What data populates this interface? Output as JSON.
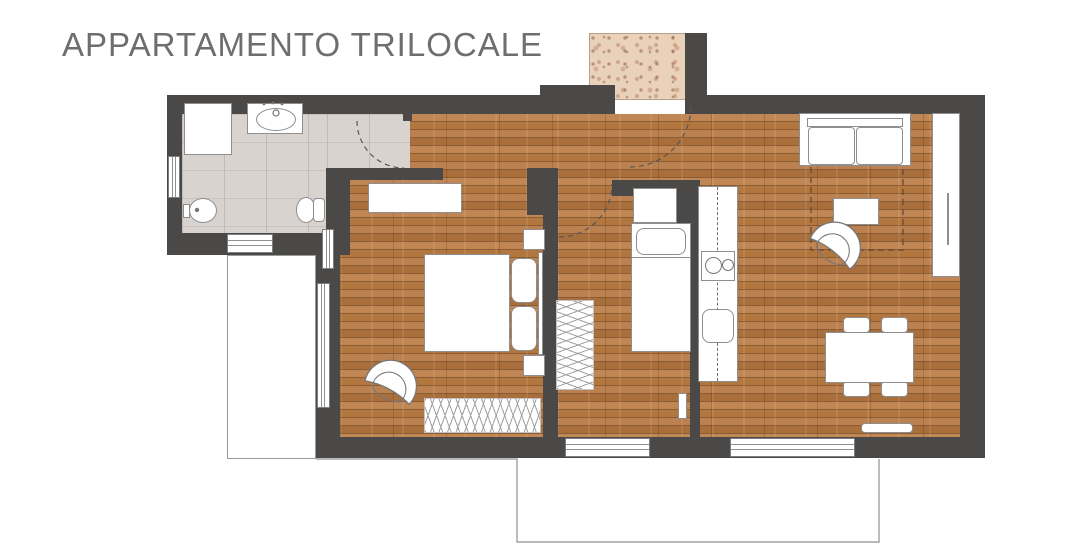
{
  "title": "APPARTAMENTO TRILOCALE",
  "colors": {
    "wall": "#4a4947",
    "wood": "#b57c48",
    "tile": "#d9d3d0",
    "landing": "#ead1ba",
    "outline": "#8e8e8e",
    "title": "#6e6e6e",
    "arc": "#565656",
    "terrace": "#8f8f8f",
    "rug-dash": "#6d4f34",
    "window-line": "#909090"
  },
  "plan": {
    "width": 1080,
    "height": 559,
    "rects": [
      {
        "name": "wood-floor",
        "cls": "wood",
        "x": 340,
        "y": 114,
        "w": 620,
        "h": 324
      },
      {
        "name": "bathroom-floor",
        "cls": "tile",
        "x": 182,
        "y": 114,
        "w": 145,
        "h": 119
      },
      {
        "name": "bathroom-vestibule-floor",
        "cls": "tile",
        "x": 327,
        "y": 114,
        "w": 83,
        "h": 54
      },
      {
        "name": "balcony-floor",
        "cls": "balcony",
        "x": 227,
        "y": 255,
        "w": 89,
        "h": 204
      },
      {
        "name": "entrance-landing",
        "cls": "landing",
        "x": 589,
        "y": 33,
        "w": 98,
        "h": 67
      },
      {
        "name": "wall-top-left",
        "cls": "wall",
        "x": 167,
        "y": 95,
        "w": 448,
        "h": 19
      },
      {
        "name": "wall-top-notch",
        "cls": "wall",
        "x": 540,
        "y": 85,
        "w": 75,
        "h": 12
      },
      {
        "name": "wall-entry-stub",
        "cls": "wall",
        "x": 685,
        "y": 33,
        "w": 22,
        "h": 81
      },
      {
        "name": "wall-top-right",
        "cls": "wall",
        "x": 685,
        "y": 95,
        "w": 300,
        "h": 19
      },
      {
        "name": "wall-right",
        "cls": "wall",
        "x": 960,
        "y": 95,
        "w": 25,
        "h": 363
      },
      {
        "name": "wall-bottom",
        "cls": "wall",
        "x": 316,
        "y": 437,
        "w": 669,
        "h": 21
      },
      {
        "name": "wall-left-bathroom",
        "cls": "wall",
        "x": 167,
        "y": 95,
        "w": 15,
        "h": 160
      },
      {
        "name": "wall-bathroom-bottom",
        "cls": "wall",
        "x": 167,
        "y": 233,
        "w": 160,
        "h": 22
      },
      {
        "name": "wall-bathroom-right",
        "cls": "wall",
        "x": 326,
        "y": 168,
        "w": 24,
        "h": 87
      },
      {
        "name": "wall-corner-bathroom-bedroom",
        "cls": "wall",
        "x": 316,
        "y": 233,
        "w": 24,
        "h": 50
      },
      {
        "name": "wall-bedroom1-left",
        "cls": "wall",
        "x": 316,
        "y": 255,
        "w": 24,
        "h": 182
      },
      {
        "name": "wall-bedroom1-top",
        "cls": "wall",
        "x": 340,
        "y": 168,
        "w": 103,
        "h": 12
      },
      {
        "name": "wall-bedroom1-corner",
        "cls": "wall",
        "x": 527,
        "y": 168,
        "w": 31,
        "h": 47
      },
      {
        "name": "wall-bedroom1-bedroom2",
        "cls": "wall",
        "x": 543,
        "y": 168,
        "w": 15,
        "h": 290
      },
      {
        "name": "wall-bedroom2-top",
        "cls": "wall",
        "x": 612,
        "y": 180,
        "w": 85,
        "h": 16
      },
      {
        "name": "wall-bedroom2-kitchen",
        "cls": "wall",
        "x": 690,
        "y": 180,
        "w": 10,
        "h": 277
      },
      {
        "name": "wall-kitchen-column",
        "cls": "wall",
        "x": 676,
        "y": 186,
        "w": 23,
        "h": 37
      },
      {
        "name": "wall-bathroom-door-jamb",
        "cls": "wall",
        "x": 403,
        "y": 95,
        "w": 9,
        "h": 26
      },
      {
        "name": "window-bathroom-left",
        "cls": "window-v",
        "x": 168,
        "y": 156,
        "w": 12,
        "h": 42
      },
      {
        "name": "window-bathroom-bottom",
        "cls": "window-h",
        "x": 227,
        "y": 234,
        "w": 46,
        "h": 19
      },
      {
        "name": "window-bedroom1-left",
        "cls": "window-v",
        "x": 322,
        "y": 229,
        "w": 12,
        "h": 40
      },
      {
        "name": "balcony-door-bedroom1",
        "cls": "window-v",
        "x": 317,
        "y": 283,
        "w": 13,
        "h": 125
      },
      {
        "name": "window-bedroom2-bottom",
        "cls": "window-h",
        "x": 565,
        "y": 438,
        "w": 85,
        "h": 19
      },
      {
        "name": "window-living-bottom",
        "cls": "window-h",
        "x": 730,
        "y": 438,
        "w": 125,
        "h": 19
      },
      {
        "name": "shower",
        "cls": "fur",
        "x": 184,
        "y": 103,
        "w": 48,
        "h": 52
      },
      {
        "name": "sink-vanity",
        "cls": "fur",
        "x": 247,
        "y": 103,
        "w": 56,
        "h": 31
      },
      {
        "name": "sink-basin",
        "cls": "oval",
        "x": 256,
        "y": 108,
        "w": 40,
        "h": 23
      },
      {
        "name": "bidet-inlet",
        "cls": "fur",
        "x": 183,
        "y": 204,
        "w": 7,
        "h": 14
      },
      {
        "name": "bidet",
        "cls": "oval",
        "x": 189,
        "y": 198,
        "w": 28,
        "h": 25
      },
      {
        "name": "toilet-bowl",
        "cls": "oval",
        "x": 296,
        "y": 197,
        "w": 20,
        "h": 26
      },
      {
        "name": "toilet-tank",
        "cls": "fur rounded-s",
        "x": 313,
        "y": 198,
        "w": 12,
        "h": 24
      },
      {
        "name": "dresser-bedroom1",
        "cls": "fur",
        "x": 368,
        "y": 183,
        "w": 94,
        "h": 30
      },
      {
        "name": "double-bed",
        "cls": "fur",
        "x": 424,
        "y": 254,
        "w": 86,
        "h": 98
      },
      {
        "name": "bed-headboard",
        "cls": "fur",
        "x": 538,
        "y": 252,
        "w": 5,
        "h": 103
      },
      {
        "name": "pillow-left",
        "cls": "pillow",
        "x": 511,
        "y": 258,
        "w": 26,
        "h": 45
      },
      {
        "name": "pillow-right",
        "cls": "pillow",
        "x": 511,
        "y": 306,
        "w": 26,
        "h": 45
      },
      {
        "name": "nightstand-top",
        "cls": "fur",
        "x": 523,
        "y": 229,
        "w": 22,
        "h": 21
      },
      {
        "name": "nightstand-bottom",
        "cls": "fur",
        "x": 523,
        "y": 355,
        "w": 22,
        "h": 21
      },
      {
        "name": "closet-bedroom1",
        "cls": "hatch-h",
        "x": 424,
        "y": 398,
        "w": 117,
        "h": 35
      },
      {
        "name": "closet-bedroom2",
        "cls": "hatch-v",
        "x": 556,
        "y": 300,
        "w": 38,
        "h": 90
      },
      {
        "name": "wardrobe-bedroom2",
        "cls": "fur",
        "x": 633,
        "y": 188,
        "w": 44,
        "h": 35
      },
      {
        "name": "single-bed",
        "cls": "fur",
        "x": 631,
        "y": 223,
        "w": 60,
        "h": 129
      },
      {
        "name": "single-bed-pillow",
        "cls": "pillow",
        "x": 636,
        "y": 228,
        "w": 50,
        "h": 27
      },
      {
        "name": "single-bed-divider",
        "cls": "line",
        "x": 631,
        "y": 257,
        "w": 60,
        "h": 1
      },
      {
        "name": "radiator-bedroom2",
        "cls": "fur",
        "x": 678,
        "y": 393,
        "w": 9,
        "h": 26
      },
      {
        "name": "kitchen-counter",
        "cls": "fur",
        "x": 698,
        "y": 186,
        "w": 40,
        "h": 196
      },
      {
        "name": "kitchen-counter-dash",
        "cls": "dashline-v",
        "x": 717,
        "y": 187,
        "w": 1,
        "h": 194
      },
      {
        "name": "cooktop",
        "cls": "fur",
        "x": 701,
        "y": 251,
        "w": 34,
        "h": 30
      },
      {
        "name": "burner-large",
        "cls": "circle",
        "x": 705,
        "y": 257,
        "w": 17,
        "h": 17
      },
      {
        "name": "burner-small",
        "cls": "circle",
        "x": 722,
        "y": 259,
        "w": 12,
        "h": 12
      },
      {
        "name": "kitchen-sink",
        "cls": "fur rounded-m",
        "x": 702,
        "y": 309,
        "w": 32,
        "h": 34
      },
      {
        "name": "sofa-base",
        "cls": "fur",
        "x": 799,
        "y": 113,
        "w": 112,
        "h": 53
      },
      {
        "name": "sofa-back",
        "cls": "fur",
        "x": 807,
        "y": 118,
        "w": 96,
        "h": 9
      },
      {
        "name": "sofa-cushion-left",
        "cls": "fur rounded-s",
        "x": 808,
        "y": 127,
        "w": 47,
        "h": 38
      },
      {
        "name": "sofa-cushion-right",
        "cls": "fur rounded-s",
        "x": 856,
        "y": 127,
        "w": 47,
        "h": 38
      },
      {
        "name": "tall-cabinet",
        "cls": "fur",
        "x": 932,
        "y": 113,
        "w": 28,
        "h": 164
      },
      {
        "name": "cabinet-handle",
        "cls": "line",
        "x": 947,
        "y": 193,
        "w": 2,
        "h": 52
      },
      {
        "name": "coffee-table",
        "cls": "fur",
        "x": 833,
        "y": 198,
        "w": 46,
        "h": 27
      },
      {
        "name": "dining-chair-top-left",
        "cls": "fur rounded-s",
        "x": 843,
        "y": 317,
        "w": 27,
        "h": 16
      },
      {
        "name": "dining-chair-top-right",
        "cls": "fur rounded-s",
        "x": 881,
        "y": 317,
        "w": 27,
        "h": 16
      },
      {
        "name": "dining-chair-bottom-left",
        "cls": "fur rounded-s",
        "x": 843,
        "y": 381,
        "w": 27,
        "h": 16
      },
      {
        "name": "dining-chair-bottom-right",
        "cls": "fur rounded-s",
        "x": 881,
        "y": 381,
        "w": 27,
        "h": 16
      },
      {
        "name": "dining-table",
        "cls": "fur",
        "x": 825,
        "y": 332,
        "w": 89,
        "h": 51
      },
      {
        "name": "radiator-living",
        "cls": "fur rounded-s",
        "x": 861,
        "y": 423,
        "w": 52,
        "h": 10
      }
    ],
    "svg": {
      "paths": [
        {
          "name": "entrance-door-arc",
          "cls": "arc",
          "d": "M 630 167 A 61 61 0 0 0 691 106"
        },
        {
          "name": "bathroom-door-arc",
          "cls": "arc",
          "d": "M 357 121 A 47 47 0 0 0 404 168"
        },
        {
          "name": "bedroom2-door-arc",
          "cls": "arc",
          "d": "M 559 237 A 53 53 0 0 0 612 184"
        },
        {
          "name": "living-rug-outline",
          "cls": "dash-brown",
          "d": "M 811 167 L 811 250 L 903 250 L 903 167"
        },
        {
          "name": "terrace-outline",
          "cls": "thin",
          "d": "M 316 459 L 517 459 L 517 542 L 879 542 L 879 459"
        },
        {
          "name": "armchair-bedroom1-body",
          "cls": "chair-fill",
          "d": "M -25 -13 A 26 26 0 1 1 25 -13 Q 0 -21 -25 -13 Z",
          "transform": "translate(381,404) rotate(28)"
        },
        {
          "name": "armchair-bedroom1-seat",
          "cls": "chair-line",
          "d": "M -16 -11 A 17 17 0 1 1 16 -11 M -16 -11 Q 0 -2 16 -11",
          "transform": "translate(381,404) rotate(28)"
        },
        {
          "name": "armchair-living-body",
          "cls": "chair-fill",
          "d": "M -25 -13 A 26 26 0 1 1 25 -13 Q 0 -21 -25 -13 Z",
          "transform": "translate(822,264) rotate(38)"
        },
        {
          "name": "armchair-living-seat",
          "cls": "chair-line",
          "d": "M -16 -11 A 17 17 0 1 1 16 -11 M -16 -11 Q 0 -2 16 -11",
          "transform": "translate(822,264) rotate(38)"
        }
      ],
      "circles": [
        {
          "name": "sink-faucet",
          "cls": "stroke-circ",
          "cx": 276,
          "cy": 113,
          "r": 3
        },
        {
          "name": "sink-faucet-dot-1",
          "cls": "dot",
          "cx": 264,
          "cy": 104,
          "r": 1.4
        },
        {
          "name": "sink-faucet-dot-2",
          "cls": "dot",
          "cx": 273,
          "cy": 103,
          "r": 1.4
        },
        {
          "name": "sink-faucet-dot-3",
          "cls": "dot",
          "cx": 282,
          "cy": 104,
          "r": 1.4
        },
        {
          "name": "bidet-tap",
          "cls": "dot",
          "cx": 197,
          "cy": 210,
          "r": 2.2
        }
      ]
    }
  }
}
